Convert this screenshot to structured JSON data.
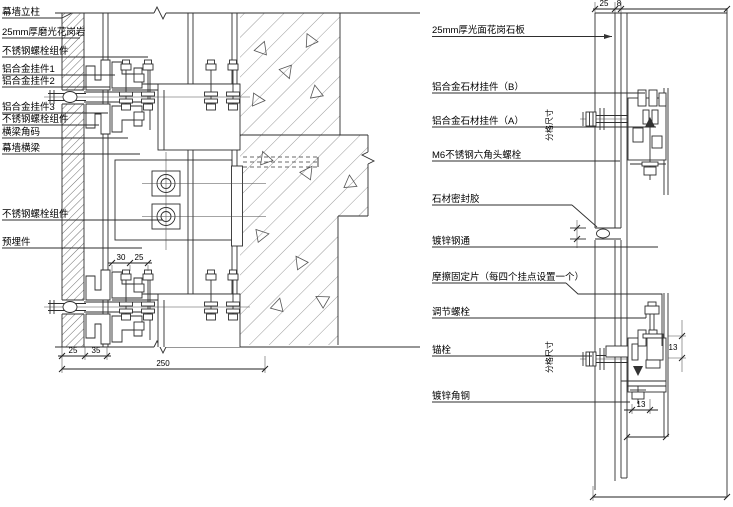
{
  "left_detail": {
    "labels": [
      "幕墙立柱",
      "25mm厚磨光花岗岩",
      "不锈钢螺栓组件",
      "铝合金挂件1",
      "铝合金挂件2",
      "铝合金挂件3",
      "不锈钢螺栓组件",
      "横梁角码",
      "幕墙横梁",
      "不锈钢螺栓组件",
      "预埋件"
    ],
    "dims": {
      "bracket": [
        "30",
        "25"
      ],
      "bottom": [
        "25",
        "35",
        "250"
      ]
    }
  },
  "right_detail": {
    "labels": [
      "25mm厚光面花岗石板",
      "铝合金石材挂件（B）",
      "铝合金石材挂件（A）",
      "M6不锈钢六角头螺栓",
      "石材密封胶",
      "镀锌钢通",
      "摩擦固定片（每四个挂点设置一个）",
      "调节螺栓",
      "锚栓",
      "镀锌角钢"
    ],
    "dims": {
      "top": [
        "25",
        "8"
      ],
      "hanger_offset": "13",
      "angle_leg": "13"
    },
    "grid_note": "分格尺寸"
  }
}
